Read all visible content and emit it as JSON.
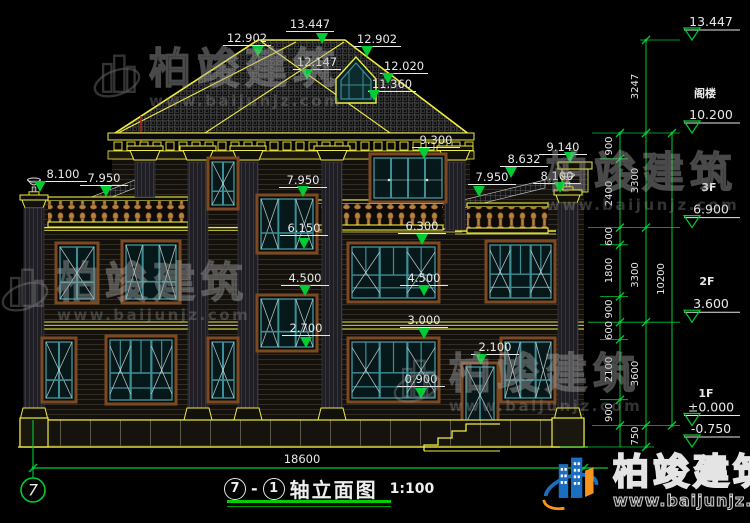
{
  "watermark": {
    "name": "柏竣建筑",
    "url": "www.baijunjz.com"
  },
  "logo": {
    "name": "柏竣建筑",
    "url": "www.baijunjz.com"
  },
  "title_bar": {
    "axis_start": "7",
    "axis_end": "1",
    "dash": "-",
    "title": "轴立面图",
    "scale": "1:100"
  },
  "axis_bubble": {
    "label": "7"
  },
  "ground_dimension": "18600",
  "facade_dims": [
    "13.447",
    "12.902",
    "12.902",
    "12.147",
    "12.020",
    "11.360",
    "9.300",
    "9.140",
    "8.632",
    "8.100",
    "7.950",
    "8.100",
    "7.950",
    "7.950",
    "6.150",
    "6.300",
    "4.500",
    "4.500",
    "2.700",
    "3.000",
    "2.100",
    "0.900"
  ],
  "right_panel": {
    "floor_labels": [
      "阁楼",
      "3F",
      "2F",
      "1F"
    ],
    "levels": [
      "13.447",
      "10.200",
      "6.900",
      "3.600",
      "±0.000",
      "-0.750"
    ],
    "chain_inner": [
      "900",
      "2400",
      "600",
      "1800",
      "900",
      "600",
      "2100",
      "900"
    ],
    "chain_mid": [
      "3247",
      "3300",
      "3300",
      "3600",
      "750"
    ],
    "chain_overall": [
      "10200"
    ]
  },
  "colors": {
    "line_yellow": "#f0ec3f",
    "dim_green": "#00cc33",
    "text_white": "#e8e8e8",
    "window_teal": "#3d8f96",
    "frame_brown": "#7c4a22",
    "baluster_tan": "#b5813f",
    "logo_blue": "#1a6ec2",
    "logo_orange": "#f7941d"
  }
}
